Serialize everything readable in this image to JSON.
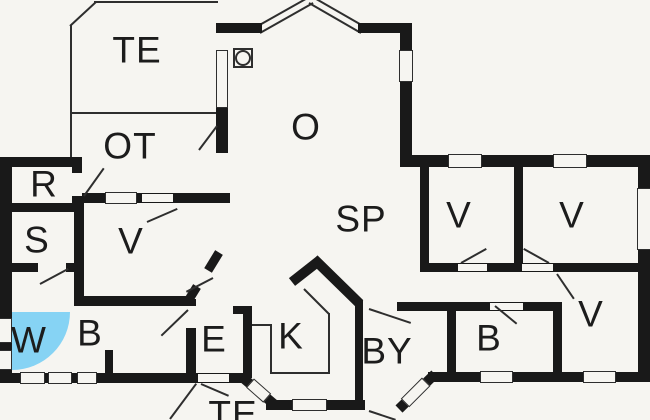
{
  "app": {
    "type": "floor-plan"
  },
  "colors": {
    "paper": "#f6f5f1",
    "wall": "#191919",
    "line": "#2e2e2e",
    "shower": "#86d3f4",
    "text": "#1c1c1c"
  },
  "rooms": [
    {
      "n": "room-label-te-top",
      "label": "TE",
      "x": 137,
      "y": 50
    },
    {
      "n": "room-label-ot",
      "label": "OT",
      "x": 130,
      "y": 146
    },
    {
      "n": "room-label-o",
      "label": "O",
      "x": 306,
      "y": 127
    },
    {
      "n": "room-label-sp",
      "label": "SP",
      "x": 361,
      "y": 219
    },
    {
      "n": "room-label-r",
      "label": "R",
      "x": 44,
      "y": 184
    },
    {
      "n": "room-label-s",
      "label": "S",
      "x": 37,
      "y": 240
    },
    {
      "n": "room-label-v-mid",
      "label": "V",
      "x": 131,
      "y": 241
    },
    {
      "n": "room-label-w",
      "label": "W",
      "x": 29,
      "y": 340
    },
    {
      "n": "room-label-b-left",
      "label": "B",
      "x": 90,
      "y": 333
    },
    {
      "n": "room-label-e",
      "label": "E",
      "x": 214,
      "y": 339
    },
    {
      "n": "room-label-k",
      "label": "K",
      "x": 291,
      "y": 336
    },
    {
      "n": "room-label-by",
      "label": "BY",
      "x": 387,
      "y": 351
    },
    {
      "n": "room-label-v-1",
      "label": "V",
      "x": 459,
      "y": 215
    },
    {
      "n": "room-label-v-2",
      "label": "V",
      "x": 572,
      "y": 215
    },
    {
      "n": "room-label-v-3",
      "label": "V",
      "x": 591,
      "y": 314
    },
    {
      "n": "room-label-b-right",
      "label": "B",
      "x": 489,
      "y": 338
    },
    {
      "n": "room-label-te-bottom",
      "label": "TE",
      "x": 233,
      "y": 414
    }
  ],
  "plan": {
    "width": 650,
    "height": 420,
    "shapes": [
      {
        "c": "shower",
        "n": "shower-icon",
        "x": 12,
        "y": 312,
        "w": 58,
        "h": 58
      },
      {
        "c": "thin",
        "n": "terrace-edge",
        "x": 70,
        "y": 25,
        "w": 2,
        "h": 88
      },
      {
        "c": "thin",
        "n": "terrace-edge",
        "x1": 70,
        "y1": 26,
        "x2": 96,
        "y2": 2,
        "t": 2
      },
      {
        "c": "thin",
        "n": "terrace-edge",
        "x": 94,
        "y": 1,
        "w": 124,
        "h": 2
      },
      {
        "c": "thin",
        "n": "terrace-edge",
        "x": 70,
        "y": 112,
        "w": 148,
        "h": 2
      },
      {
        "c": "thin",
        "n": "terrace-edge",
        "x": 70,
        "y": 114,
        "w": 2,
        "h": 45
      },
      {
        "c": "thin",
        "n": "bay-window",
        "x1": 256,
        "y1": 27,
        "x2": 311,
        "y2": -4,
        "t": 2
      },
      {
        "c": "thin",
        "n": "bay-window",
        "x1": 311,
        "y1": -4,
        "x2": 365,
        "y2": 27,
        "t": 2
      },
      {
        "c": "thin",
        "n": "bay-window",
        "x1": 260,
        "y1": 33,
        "x2": 313,
        "y2": 3,
        "t": 2
      },
      {
        "c": "thin",
        "n": "bay-window",
        "x1": 309,
        "y1": 3,
        "x2": 361,
        "y2": 33,
        "t": 2
      },
      {
        "c": "thin",
        "n": "kitchen-counter",
        "x": 252,
        "y": 324,
        "w": 18,
        "h": 2
      },
      {
        "c": "thin",
        "n": "kitchen-counter",
        "x": 270,
        "y": 324,
        "w": 2,
        "h": 50
      },
      {
        "c": "thin",
        "n": "kitchen-counter",
        "x": 270,
        "y": 372,
        "w": 60,
        "h": 2
      },
      {
        "c": "thin",
        "n": "kitchen-counter",
        "x": 328,
        "y": 313,
        "w": 2,
        "h": 61
      },
      {
        "c": "thin",
        "n": "kitchen-counter",
        "x1": 304,
        "y1": 289,
        "x2": 329,
        "y2": 314,
        "t": 2
      },
      {
        "c": "thin",
        "n": "terrace-edge",
        "x1": 170,
        "y1": 419,
        "x2": 196,
        "y2": 384,
        "t": 2
      },
      {
        "c": "wall",
        "n": "wall",
        "x": 216,
        "y": 23,
        "w": 46,
        "h": 10
      },
      {
        "c": "wall",
        "n": "wall",
        "x": 358,
        "y": 23,
        "w": 54,
        "h": 10
      },
      {
        "c": "wall",
        "n": "wall",
        "x": 400,
        "y": 23,
        "w": 12,
        "h": 27
      },
      {
        "c": "wall",
        "n": "wall",
        "x": 400,
        "y": 82,
        "w": 12,
        "h": 75
      },
      {
        "c": "wall",
        "n": "wall",
        "x": 400,
        "y": 155,
        "w": 250,
        "h": 12
      },
      {
        "c": "wall",
        "n": "wall",
        "x": 638,
        "y": 155,
        "w": 12,
        "h": 227
      },
      {
        "c": "wall",
        "n": "wall",
        "x": 428,
        "y": 372,
        "w": 222,
        "h": 10
      },
      {
        "c": "wall",
        "n": "wall",
        "x1": 399,
        "y1": 409,
        "x2": 435,
        "y2": 374,
        "t": 10
      },
      {
        "c": "wall",
        "n": "wall",
        "x": 0,
        "y": 373,
        "w": 246,
        "h": 10
      },
      {
        "c": "wall",
        "n": "wall",
        "x1": 242,
        "y1": 377,
        "x2": 275,
        "y2": 405,
        "t": 10
      },
      {
        "c": "wall",
        "n": "wall",
        "x": 266,
        "y": 400,
        "w": 99,
        "h": 10
      },
      {
        "c": "wall",
        "n": "wall",
        "x": 355,
        "y": 300,
        "w": 8,
        "h": 110
      },
      {
        "c": "wall",
        "n": "wall",
        "x1": 314,
        "y1": 259,
        "x2": 360,
        "y2": 304,
        "t": 10
      },
      {
        "c": "wall",
        "n": "wall",
        "x1": 292,
        "y1": 282,
        "x2": 320,
        "y2": 260,
        "t": 10
      },
      {
        "c": "wall",
        "n": "wall",
        "x": 233,
        "y": 306,
        "w": 19,
        "h": 8
      },
      {
        "c": "wall",
        "n": "wall",
        "x": 243,
        "y": 306,
        "w": 9,
        "h": 72
      },
      {
        "c": "wall",
        "n": "wall",
        "x": 447,
        "y": 302,
        "w": 9,
        "h": 70
      },
      {
        "c": "wall",
        "n": "wall",
        "x": 553,
        "y": 302,
        "w": 9,
        "h": 70
      },
      {
        "c": "wall",
        "n": "wall",
        "x": 420,
        "y": 263,
        "w": 220,
        "h": 9
      },
      {
        "c": "wall",
        "n": "wall",
        "x": 397,
        "y": 302,
        "w": 165,
        "h": 9
      },
      {
        "c": "wall",
        "n": "wall",
        "x": 420,
        "y": 165,
        "w": 9,
        "h": 103
      },
      {
        "c": "wall",
        "n": "wall",
        "x": 514,
        "y": 165,
        "w": 9,
        "h": 103
      },
      {
        "c": "wall",
        "n": "wall",
        "x": 0,
        "y": 157,
        "w": 12,
        "h": 226
      },
      {
        "c": "wall",
        "n": "wall",
        "x": 0,
        "y": 157,
        "w": 82,
        "h": 10
      },
      {
        "c": "wall",
        "n": "wall",
        "x": 0,
        "y": 203,
        "w": 76,
        "h": 9
      },
      {
        "c": "wall",
        "n": "wall",
        "x": 72,
        "y": 157,
        "w": 10,
        "h": 16
      },
      {
        "c": "wall",
        "n": "wall",
        "x": 72,
        "y": 196,
        "w": 10,
        "h": 16
      },
      {
        "c": "wall",
        "n": "wall",
        "x": 74,
        "y": 203,
        "w": 10,
        "h": 103
      },
      {
        "c": "wall",
        "n": "wall",
        "x": 6,
        "y": 263,
        "w": 32,
        "h": 9
      },
      {
        "c": "wall",
        "n": "wall",
        "x": 66,
        "y": 263,
        "w": 10,
        "h": 9
      },
      {
        "c": "wall",
        "n": "wall",
        "x": 74,
        "y": 296,
        "w": 118,
        "h": 10
      },
      {
        "c": "wall",
        "n": "wall",
        "x": 74,
        "y": 193,
        "w": 156,
        "h": 10
      },
      {
        "c": "wall",
        "n": "wall",
        "x": 216,
        "y": 108,
        "w": 12,
        "h": 45
      },
      {
        "c": "wall",
        "n": "wall",
        "x": 105,
        "y": 350,
        "w": 8,
        "h": 23
      },
      {
        "c": "wall",
        "n": "wall",
        "x1": 219,
        "y1": 252,
        "x2": 208,
        "y2": 270,
        "t": 9
      },
      {
        "c": "wall",
        "n": "wall",
        "x1": 197,
        "y1": 286,
        "x2": 189,
        "y2": 299,
        "t": 9
      },
      {
        "c": "wall",
        "n": "wall",
        "x": 186,
        "y": 299,
        "w": 10,
        "h": 7
      },
      {
        "c": "wall",
        "n": "wall",
        "x": 186,
        "y": 328,
        "w": 10,
        "h": 50
      },
      {
        "c": "gap",
        "n": "door-opening",
        "x": 72,
        "y": 173,
        "w": 10,
        "h": 23
      },
      {
        "c": "gap",
        "n": "door-opening",
        "x": 142,
        "y": 194,
        "w": 31,
        "h": 8
      },
      {
        "c": "gap",
        "n": "door-opening",
        "x": 38,
        "y": 264,
        "w": 28,
        "h": 7
      },
      {
        "c": "gap",
        "n": "door-opening",
        "x": 458,
        "y": 264,
        "w": 29,
        "h": 7
      },
      {
        "c": "gap",
        "n": "door-opening",
        "x": 522,
        "y": 264,
        "w": 31,
        "h": 7
      },
      {
        "c": "gap",
        "n": "door-opening",
        "x": 490,
        "y": 303,
        "w": 33,
        "h": 7
      },
      {
        "c": "gap",
        "n": "door-opening",
        "x": 198,
        "y": 374,
        "w": 31,
        "h": 8
      },
      {
        "c": "win",
        "n": "window",
        "x": 399,
        "y": 50,
        "w": 14,
        "h": 32
      },
      {
        "c": "win",
        "n": "window",
        "x": 216,
        "y": 50,
        "w": 12,
        "h": 58
      },
      {
        "c": "win",
        "n": "window",
        "x": 448,
        "y": 154,
        "w": 34,
        "h": 14
      },
      {
        "c": "win",
        "n": "window",
        "x": 553,
        "y": 154,
        "w": 34,
        "h": 14
      },
      {
        "c": "win",
        "n": "window",
        "x": 637,
        "y": 188,
        "w": 14,
        "h": 62
      },
      {
        "c": "win",
        "n": "window",
        "x": 480,
        "y": 371,
        "w": 33,
        "h": 12
      },
      {
        "c": "win",
        "n": "window",
        "x": 583,
        "y": 371,
        "w": 33,
        "h": 12
      },
      {
        "c": "win",
        "n": "window",
        "x": 20,
        "y": 372,
        "w": 25,
        "h": 12
      },
      {
        "c": "win",
        "n": "window",
        "x": 48,
        "y": 372,
        "w": 24,
        "h": 12
      },
      {
        "c": "win",
        "n": "window",
        "x": 77,
        "y": 372,
        "w": 20,
        "h": 12
      },
      {
        "c": "win",
        "n": "window",
        "x": 292,
        "y": 399,
        "w": 35,
        "h": 12
      },
      {
        "c": "win",
        "n": "window",
        "x": -2,
        "y": 318,
        "w": 14,
        "h": 25
      },
      {
        "c": "win",
        "n": "window",
        "x": -2,
        "y": 350,
        "w": 14,
        "h": 20
      },
      {
        "c": "win",
        "n": "window",
        "x": 105,
        "y": 192,
        "w": 32,
        "h": 12
      },
      {
        "c": "win",
        "n": "window",
        "x1": 405,
        "y1": 403,
        "x2": 426,
        "y2": 382,
        "t": 12
      },
      {
        "c": "win",
        "n": "window",
        "x1": 250,
        "y1": 383,
        "x2": 267,
        "y2": 398,
        "t": 12
      },
      {
        "c": "swing",
        "n": "door-swing",
        "x1": 84,
        "y1": 196,
        "x2": 104,
        "y2": 168,
        "t": 2
      },
      {
        "c": "swing",
        "n": "door-swing",
        "x1": 217,
        "y1": 126,
        "x2": 199,
        "y2": 150,
        "t": 2
      },
      {
        "c": "swing",
        "n": "door-swing",
        "x1": 147,
        "y1": 222,
        "x2": 177,
        "y2": 209,
        "t": 2
      },
      {
        "c": "swing",
        "n": "door-swing",
        "x1": 213,
        "y1": 278,
        "x2": 186,
        "y2": 292,
        "t": 2
      },
      {
        "c": "swing",
        "n": "door-swing",
        "x1": 188,
        "y1": 310,
        "x2": 161,
        "y2": 336,
        "t": 2
      },
      {
        "c": "swing",
        "n": "door-swing",
        "x1": 40,
        "y1": 284,
        "x2": 68,
        "y2": 269,
        "t": 2
      },
      {
        "c": "swing",
        "n": "door-swing",
        "x1": 201,
        "y1": 384,
        "x2": 229,
        "y2": 396,
        "t": 2
      },
      {
        "c": "swing",
        "n": "door-swing",
        "x1": 461,
        "y1": 263,
        "x2": 486,
        "y2": 249,
        "t": 2
      },
      {
        "c": "swing",
        "n": "door-swing",
        "x1": 549,
        "y1": 263,
        "x2": 524,
        "y2": 249,
        "t": 2
      },
      {
        "c": "swing",
        "n": "door-swing",
        "x1": 557,
        "y1": 274,
        "x2": 574,
        "y2": 299,
        "t": 2
      },
      {
        "c": "swing",
        "n": "door-swing",
        "x1": 369,
        "y1": 309,
        "x2": 411,
        "y2": 323,
        "t": 2
      },
      {
        "c": "swing",
        "n": "door-swing",
        "x1": 495,
        "y1": 306,
        "x2": 517,
        "y2": 324,
        "t": 2
      },
      {
        "c": "swing",
        "n": "door-swing",
        "x1": 369,
        "y1": 411,
        "x2": 396,
        "y2": 420,
        "t": 2
      },
      {
        "c": "sym-square",
        "n": "stove-icon",
        "x": 233,
        "y": 48,
        "w": 20,
        "h": 20
      },
      {
        "c": "sym-circle",
        "n": "stove-icon",
        "x": 235,
        "y": 50,
        "w": 16,
        "h": 16
      }
    ]
  }
}
